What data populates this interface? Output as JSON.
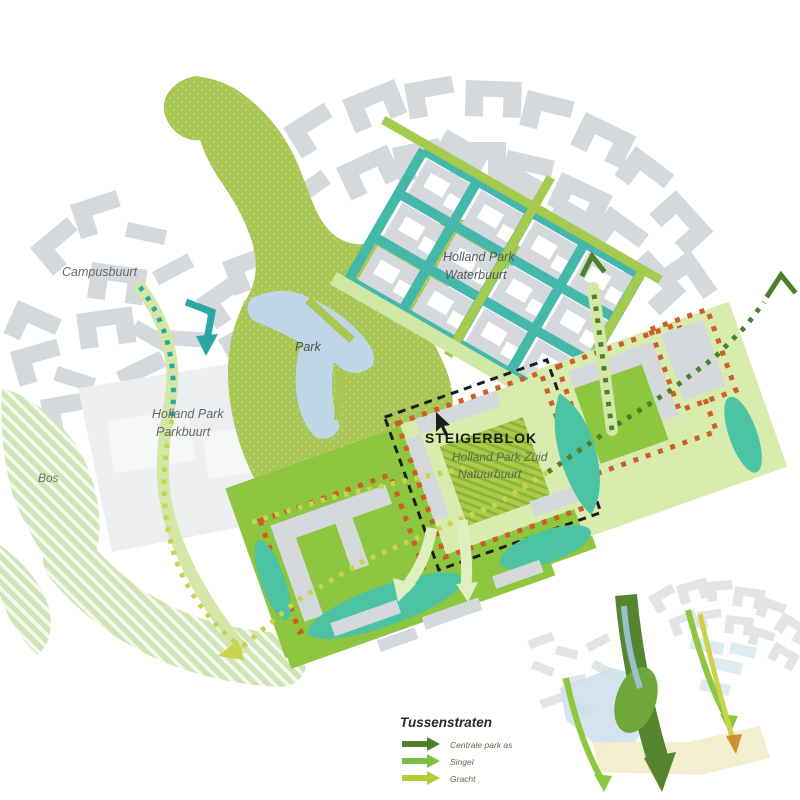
{
  "palette": {
    "bldg-gray": "#d6d9db",
    "bldg-light": "#e2e4e6",
    "block-pale": "#eceef0",
    "park-green": "#a8c653",
    "band-green": "#8dc63f",
    "pale-green": "#d8ecae",
    "bos-green": "#cfe5b6",
    "canal-teal": "#45b8ac",
    "pond-teal": "#4cc3a2",
    "lake-blue": "#bdd7e7",
    "route-yellow": "#c8d44e",
    "route-dark": "#4e7f2c",
    "route-mid": "#7cbf45",
    "route-band": "#d3e8a6",
    "orange-dot": "#cb5f27",
    "street-green": "#a5cb4e",
    "arrow-pale": "#dff0bf",
    "label-gray": "#63686b",
    "label-olive": "#5c684d",
    "inset-dark": "#55862f"
  },
  "map": {
    "labels": {
      "campusbuurt": "Campusbuurt",
      "waterbuurt_1": "Holland Park",
      "waterbuurt_2": "Waterbuurt",
      "park": "Park",
      "parkbuurt_1": "Holland Park",
      "parkbuurt_2": "Parkbuurt",
      "bos": "Bos",
      "steigerblok": "STEIGERBLOK",
      "zuid_1": "Holland Park Zuid",
      "zuid_2": "Natuurbuurt"
    }
  },
  "legend": {
    "title": "Tussenstraten",
    "items": [
      {
        "label": "Centrale park as",
        "color": "#4e7f2c"
      },
      {
        "label": "Singel",
        "color": "#7cbf45"
      },
      {
        "label": "Gracht",
        "color": "#b5cc3d"
      }
    ]
  }
}
